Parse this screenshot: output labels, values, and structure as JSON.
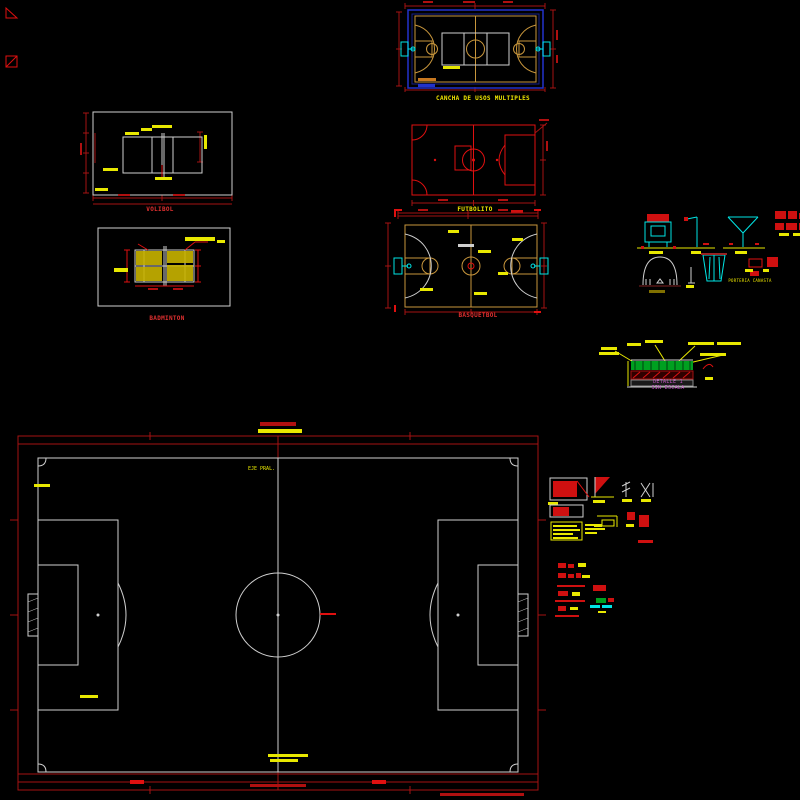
{
  "canvas": {
    "width": 800,
    "height": 800,
    "background": "#000000"
  },
  "palette": {
    "dim_red": "#a51212",
    "bright_red": "#e01010",
    "yellow": "#f0e800",
    "cyan": "#00e5e5",
    "white_line": "#cfcfcf",
    "tan": "#c8963c",
    "blue": "#2233cc",
    "green": "#00a020",
    "magenta": "#c455c4"
  },
  "drawings": {
    "multi_court": {
      "caption": "CANCHA DE USOS MULTIPLES"
    },
    "volleyball": {
      "caption": "VOLIBOL"
    },
    "badminton": {
      "caption": "BADMINTON"
    },
    "futbolito": {
      "caption": "FUTBOLITO"
    },
    "basketball": {
      "caption": "BASQUETBOL"
    },
    "equipment_details": {
      "caption": "PORTERIA CANASTA"
    },
    "section_detail": {
      "title": "DETALLE 1",
      "scale_note": "SIN ESCALA"
    },
    "soccer_field": {
      "axis_label": "EJE PRAL."
    }
  }
}
